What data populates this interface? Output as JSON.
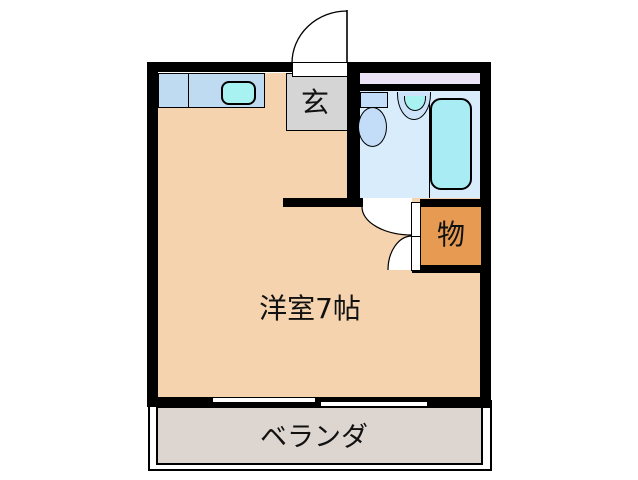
{
  "floorplan": {
    "title": "1R apartment floor plan",
    "labels": {
      "main_room": "洋室7帖",
      "entrance": "玄",
      "closet": "物",
      "veranda": "ベランダ"
    },
    "fixtures": [
      "entrance-door-swing-icon",
      "kitchen-counter-icon",
      "kitchen-sink-icon",
      "toilet-icon",
      "wash-basin-icon",
      "bathtub-icon",
      "bathroom-window-strip-icon",
      "closet-double-door-icon",
      "sliding-window-icon"
    ],
    "colors": {
      "room_floor": "#f4d3ae",
      "entrance_floor": "#d5d5d5",
      "closet": "#e79b52",
      "veranda": "#ddd5d0",
      "bathroom_floor": "#d9ecfb",
      "counter": "#bedbf2",
      "sink_cyan": "#a9f2f2",
      "bathtub": "#a9ecf4",
      "fixture_blue": "#c3ddf8",
      "window_strip": "#ede3f7",
      "wall": "#000000"
    }
  }
}
